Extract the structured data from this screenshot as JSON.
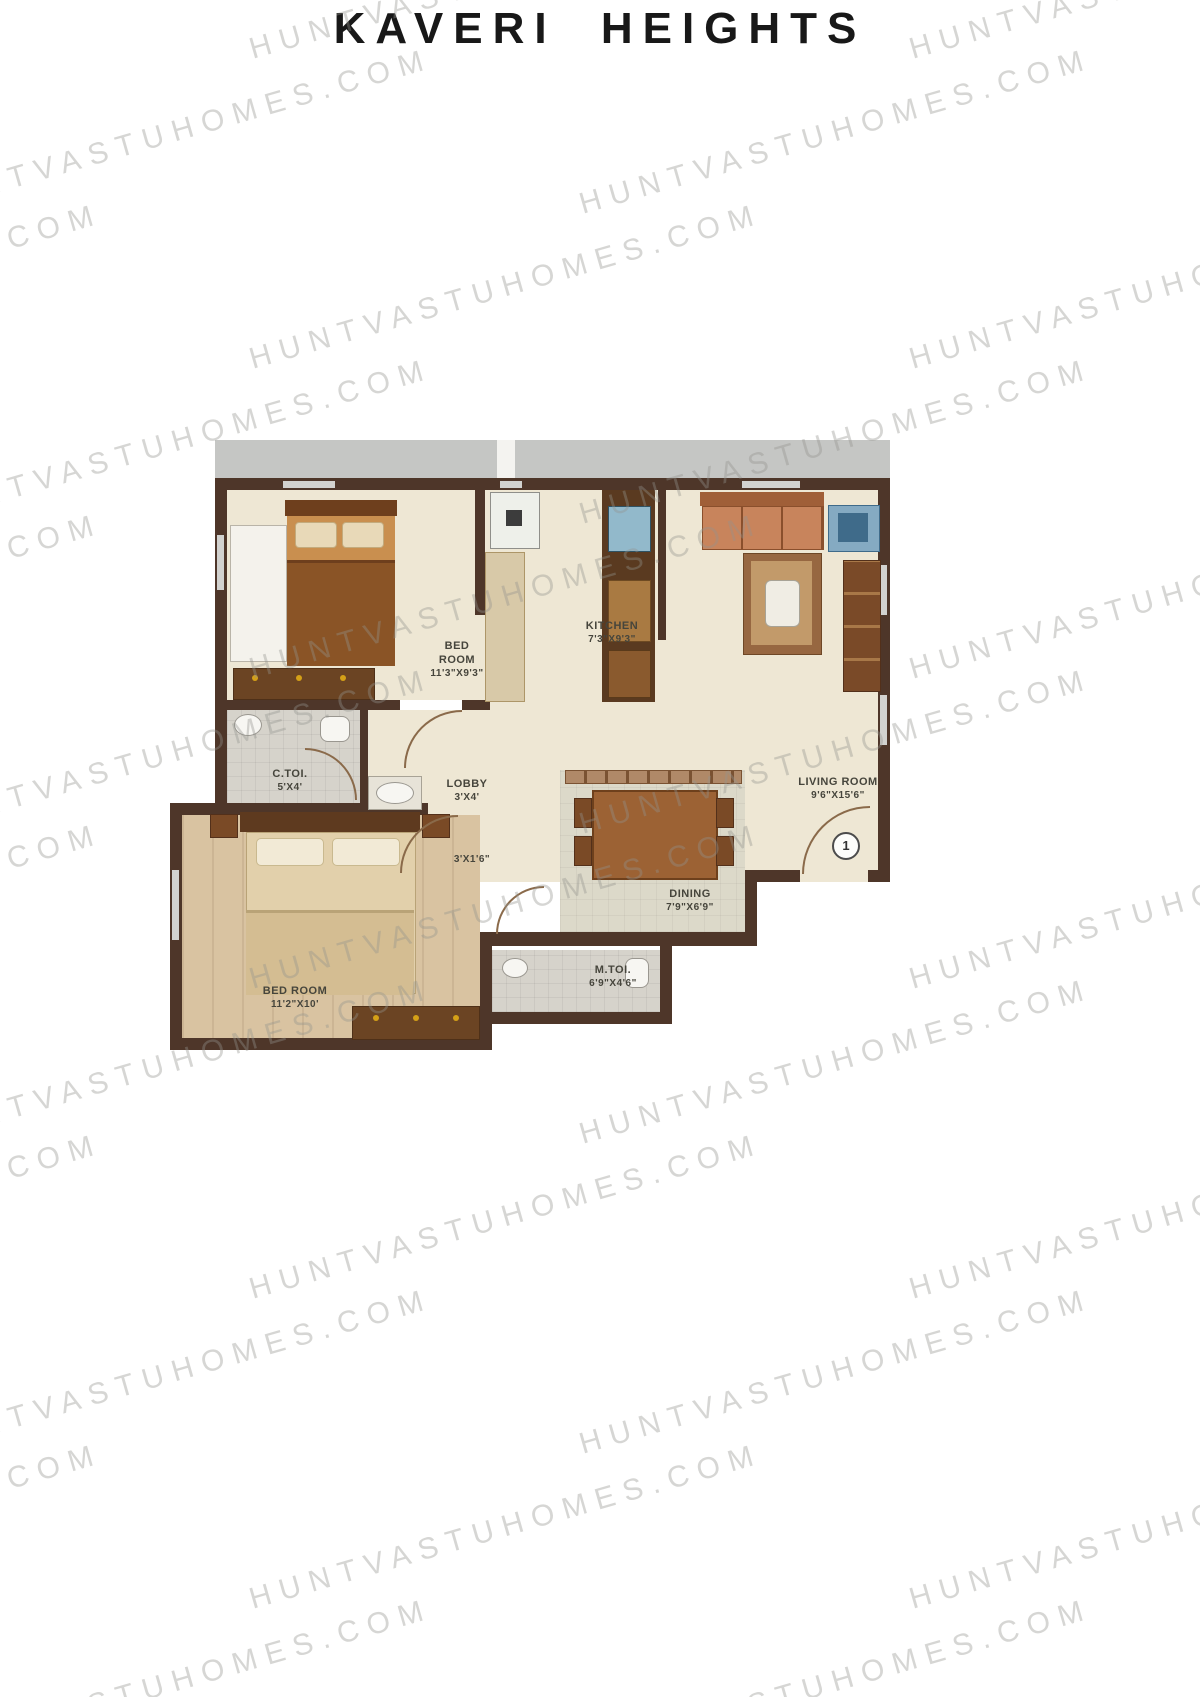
{
  "title": "KAVERI HEIGHTS",
  "watermark": {
    "text": "HUNTVASTUHOMES.COM"
  },
  "plan": {
    "rooms": {
      "bedroom1": {
        "name": "BED ROOM",
        "dims": "11'3\"X9'3\""
      },
      "kitchen": {
        "name": "KITCHEN",
        "dims": "7'3\"X9'3\""
      },
      "living": {
        "name": "LIVING ROOM",
        "dims": "9'6\"X15'6\""
      },
      "ctoi": {
        "name": "C.TOI.",
        "dims": "5'X4'"
      },
      "lobby": {
        "name": "LOBBY",
        "dims": "3'X4'"
      },
      "passage": {
        "dims": "3'X1'6\""
      },
      "dining": {
        "name": "DINING",
        "dims": "7'9\"X6'9\""
      },
      "mtoi": {
        "name": "M.TOI.",
        "dims": "6'9\"X4'6\""
      },
      "bedroom2": {
        "name": "BED ROOM",
        "dims": "11'2\"X10'"
      }
    },
    "entrance_marker": "1"
  },
  "colors": {
    "wall": "#4e3629",
    "floor_cream": "#eee7d4",
    "floor_tile": "#d6d3cb",
    "floor_wood": "#d9c3a1",
    "floor_dining": "#dcd9c9",
    "corridor_gray": "#c5c6c4",
    "title_text": "#181818",
    "watermark_gray": "#94928e"
  }
}
